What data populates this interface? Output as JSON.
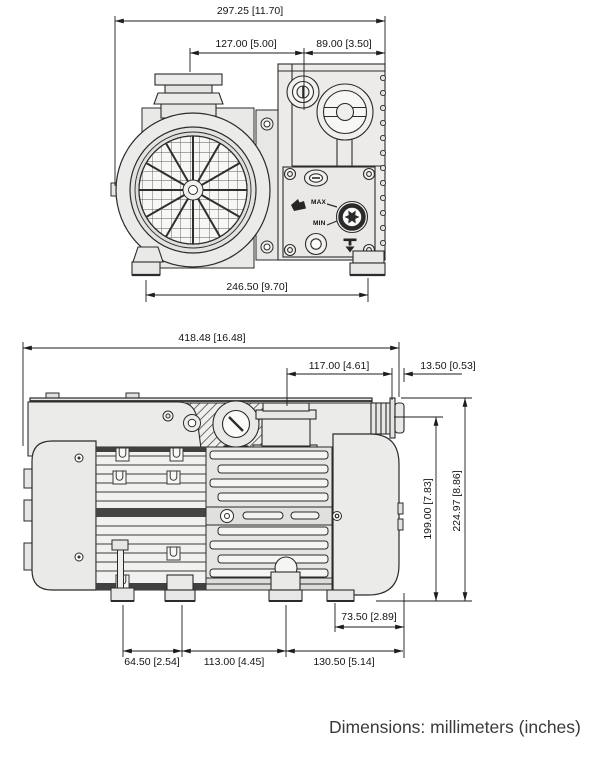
{
  "footer": {
    "note": "Dimensions: millimeters (inches)"
  },
  "top_view": {
    "title": "pump front end view",
    "dims": {
      "overall_width": "297.25 [11.70]",
      "flange_to_inlet": "127.00 [5.00]",
      "inlet_to_edge": "89.00 [3.50]",
      "foot_span": "246.50 [9.70]"
    },
    "oil_labels": {
      "max": "MAX",
      "min": "MIN"
    }
  },
  "side_view": {
    "title": "pump side view",
    "dims": {
      "overall_length": "418.48 [16.48]",
      "inlet_to_port_face": "117.00 [4.61]",
      "port_protrusion": "13.50 [0.53]",
      "body_height": "199.00 [7.83]",
      "overall_height": "224.97 [8.86]",
      "foot_to_port": "73.50 [2.89]",
      "foot_span_a": "64.50 [2.54]",
      "foot_span_b": "113.00 [4.45]",
      "foot_span_c": "130.50 [5.14]"
    }
  },
  "colors": {
    "line": "#2b2b2b",
    "dim_line": "#1c1c1c",
    "metal": "#ebebe9"
  }
}
